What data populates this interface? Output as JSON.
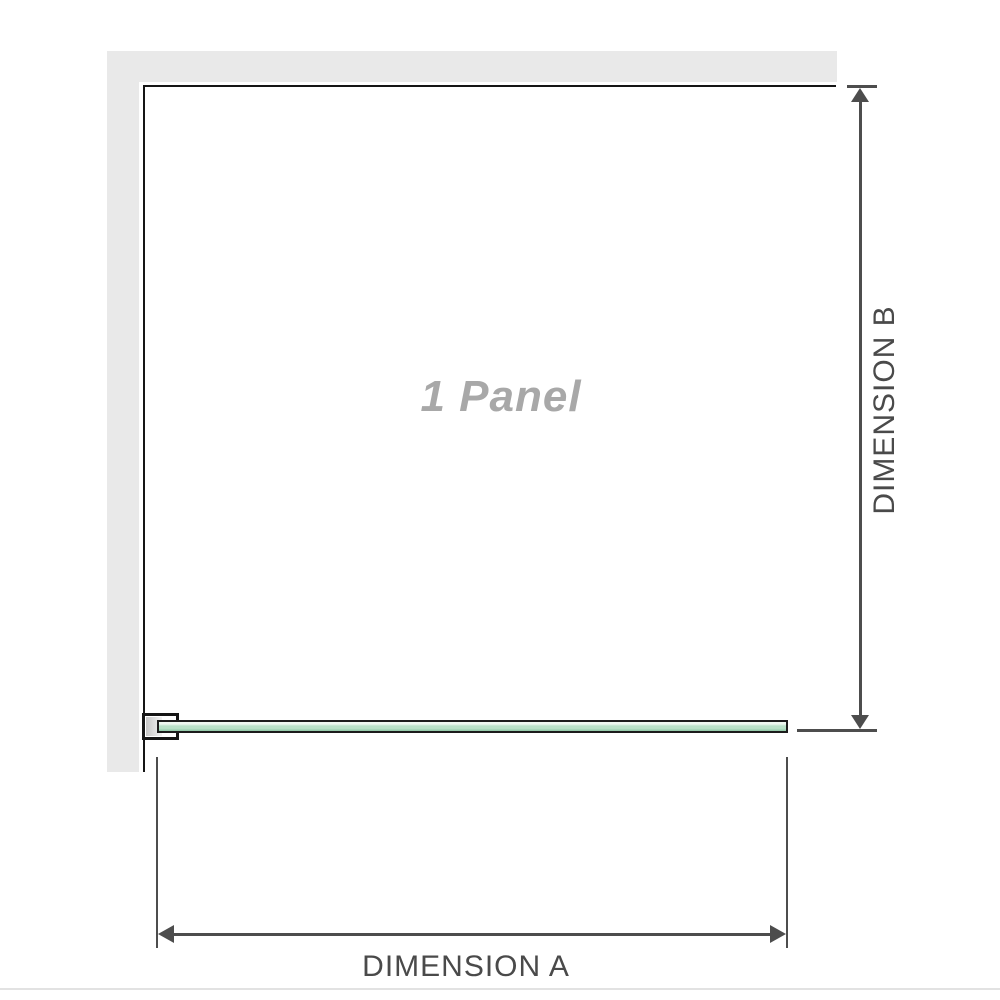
{
  "diagram": {
    "panel": {
      "label": "1 Panel"
    },
    "dimensions": {
      "a": {
        "label": "DIMENSION A",
        "orientation": "horizontal"
      },
      "b": {
        "label": "DIMENSION B",
        "orientation": "vertical"
      }
    }
  },
  "colors": {
    "wall": "#e9e9e9",
    "panel_border": "#151515",
    "glass_light": "#eef7f0",
    "glass_mid": "#b9e1c8",
    "glass_dark": "#8fc7a6",
    "dimension": "#4d4d4d",
    "label": "#4a4a4a",
    "panel_text": "#a8a8a8",
    "separator": "#e2e2e2"
  }
}
